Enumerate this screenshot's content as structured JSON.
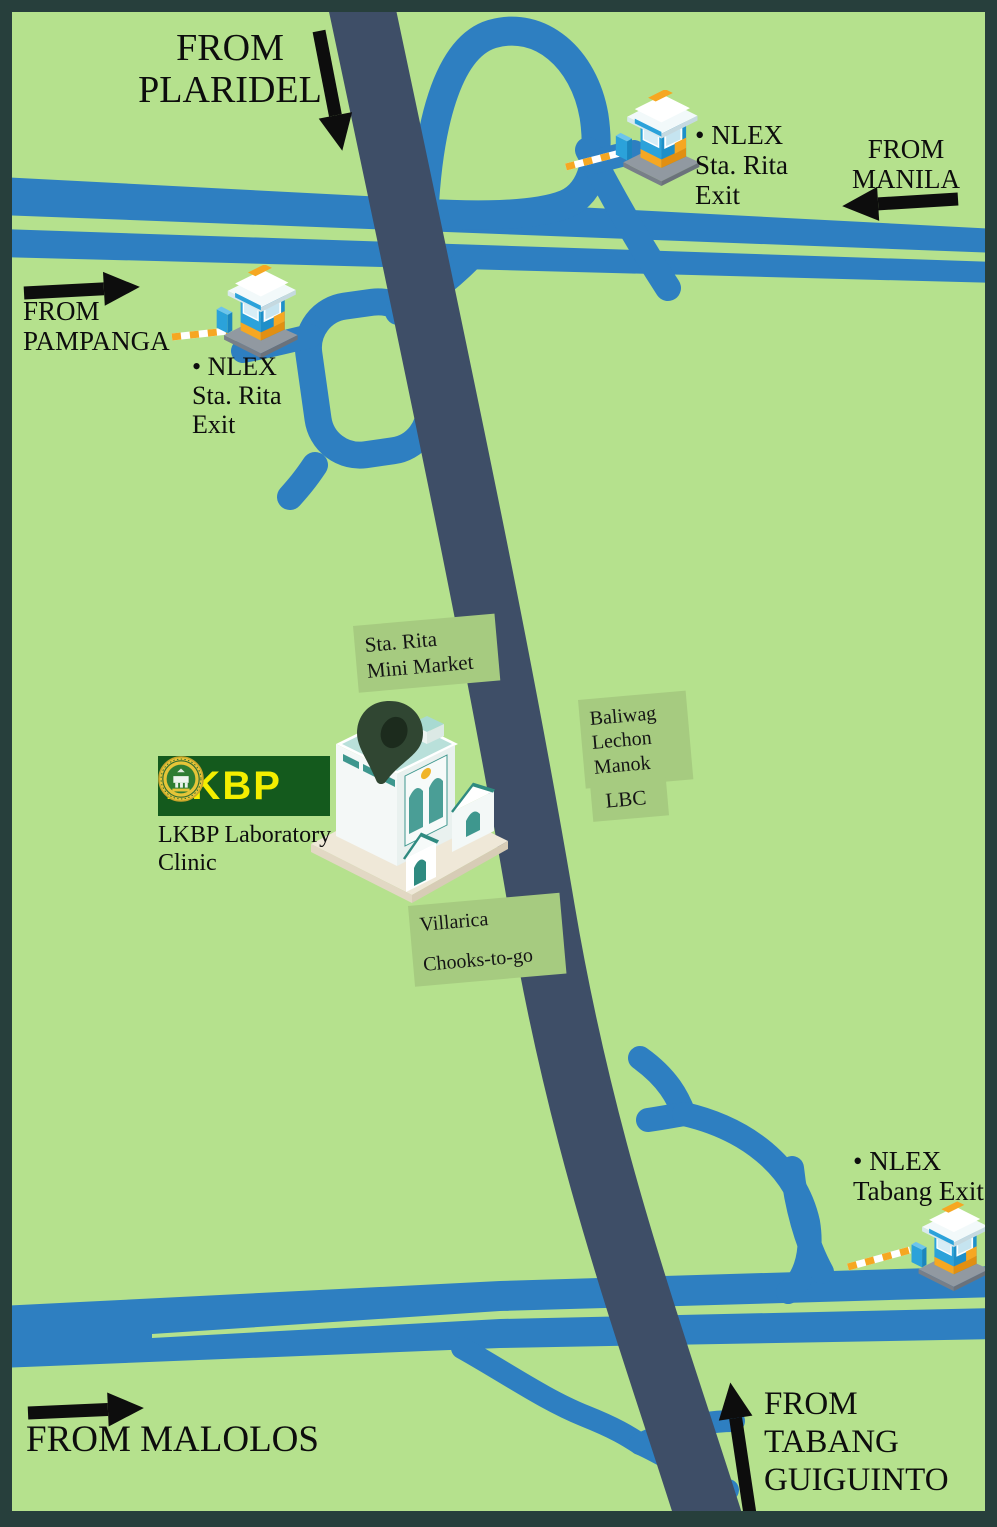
{
  "title": "LKBP Laboratory Clinic location map",
  "colors": {
    "frame": "#273F3C",
    "map_green": "#B5E18D",
    "road_blue": "#2E7FC1",
    "main_road_navy": "#3E4E67",
    "label_box_green": "#A6CB80",
    "arrow_text_black": "#0D0D0D",
    "logo_green": "#145A1D",
    "logo_yellow": "#F4EE00",
    "booth_blue": "#2BA2DA",
    "booth_orange": "#F6A722"
  },
  "directions": {
    "plaridel": {
      "lines": [
        "FROM",
        "PLARIDEL"
      ]
    },
    "manila": {
      "lines": [
        "FROM",
        "MANILA"
      ]
    },
    "pampanga": {
      "lines": [
        "FROM",
        "PAMPANGA"
      ]
    },
    "malolos": {
      "lines": [
        "FROM MALOLOS"
      ]
    },
    "tabang_guiguinto": {
      "lines": [
        "FROM",
        "TABANG",
        "GUIGUINTO"
      ]
    }
  },
  "exits": {
    "sta_rita_north": {
      "lines": [
        "• NLEX",
        "Sta. Rita",
        "Exit"
      ]
    },
    "sta_rita_west": {
      "lines": [
        "• NLEX",
        "Sta. Rita",
        "Exit"
      ]
    },
    "tabang": {
      "lines": [
        "• NLEX",
        "Tabang Exit"
      ]
    }
  },
  "landmarks": {
    "mini_market": {
      "lines": [
        "Sta. Rita",
        "Mini Market"
      ]
    },
    "baliwag_lechon_manok": {
      "lines": [
        "Baliwag",
        "Lechon",
        "Manok"
      ]
    },
    "lbc": {
      "lines": [
        "LBC"
      ]
    },
    "villarica_box": {
      "lines": [
        "Villarica",
        "Chooks-to-go"
      ]
    }
  },
  "clinic": {
    "logo_text": "LKBP",
    "caption": {
      "lines": [
        "LKBP Laboratory",
        "Clinic"
      ]
    }
  }
}
